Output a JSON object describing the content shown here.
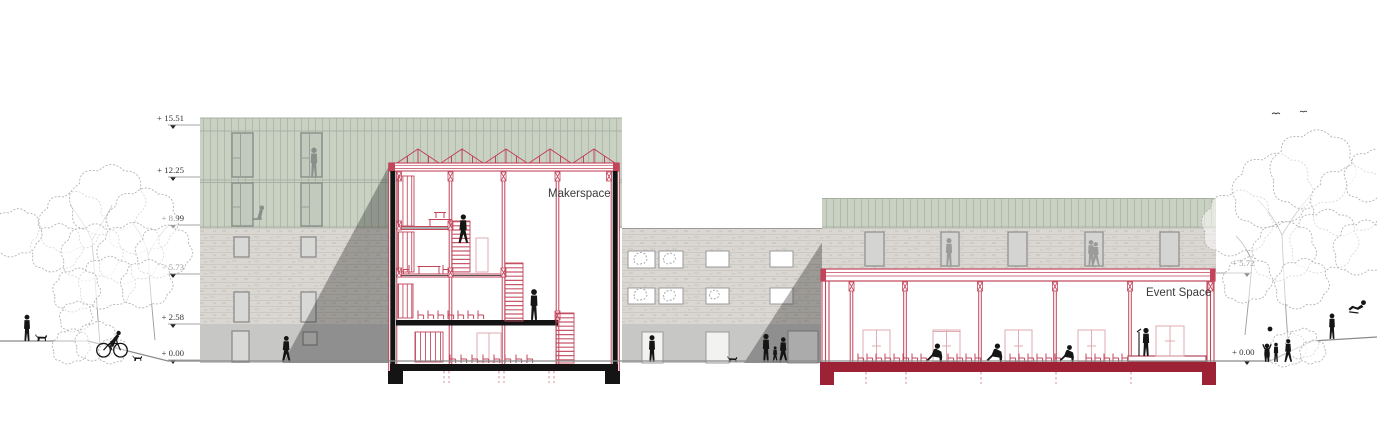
{
  "drawing": {
    "annotations": {
      "makerspace_label": "Makerspace",
      "event_space_label": "Event Space"
    },
    "levels_left": [
      "+ 15.51",
      "+ 12.25",
      "+ 8.99",
      "+ 5.73",
      "+ 2.58",
      "+ 0.00"
    ],
    "levels_right": [
      "+ 5.72",
      "+ 0.00"
    ],
    "colors": {
      "section_red": "#c2455a",
      "light_red": "#dfaab2",
      "slab_dark_red": "#9e2236",
      "cladding_green": "#c9d1c3",
      "brick_grey": "#dad7d2",
      "concrete_grey": "#c7c7c6",
      "shadow_overlay": "rgba(40,40,40,0.35)",
      "silhouette_black": "#151515",
      "sketch_grey": "#b3b3b3"
    }
  }
}
